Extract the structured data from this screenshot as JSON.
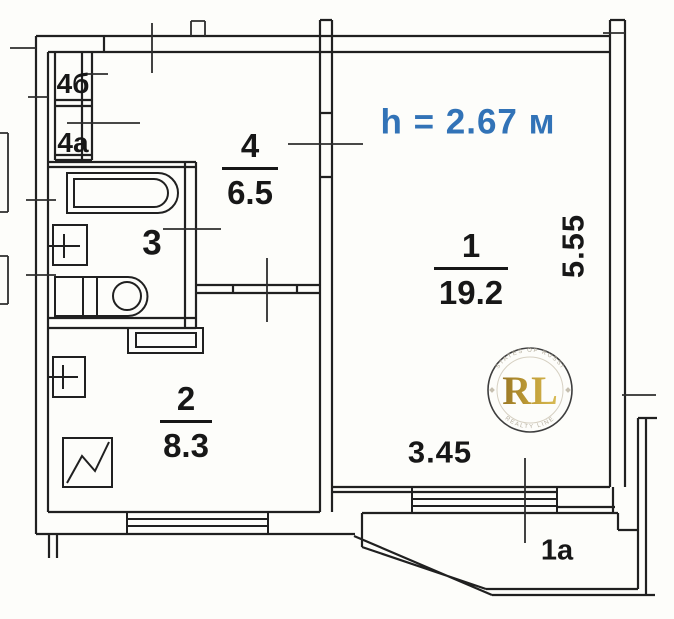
{
  "plan": {
    "height_note": "h = 2.67 м",
    "rooms": {
      "living": {
        "number": "1",
        "area": "19.2"
      },
      "hall": {
        "number": "2",
        "area": "8.3"
      },
      "bath": {
        "number": "3"
      },
      "kitchen": {
        "number": "4",
        "area": "6.5"
      },
      "closet_b": {
        "number": "4б"
      },
      "closet_a": {
        "number": "4а"
      },
      "balcony": {
        "number": "1а"
      }
    },
    "dimensions": {
      "width": "3.45",
      "height": "5.55"
    },
    "watermark": {
      "initials": "RL",
      "arc_top": "ESTATES OF RUSSIA",
      "arc_bottom": "REALTY LINE"
    },
    "colors": {
      "height_note": "#3273b7",
      "watermark_gold": "#b68f2e",
      "line": "#1f1f1f"
    }
  }
}
